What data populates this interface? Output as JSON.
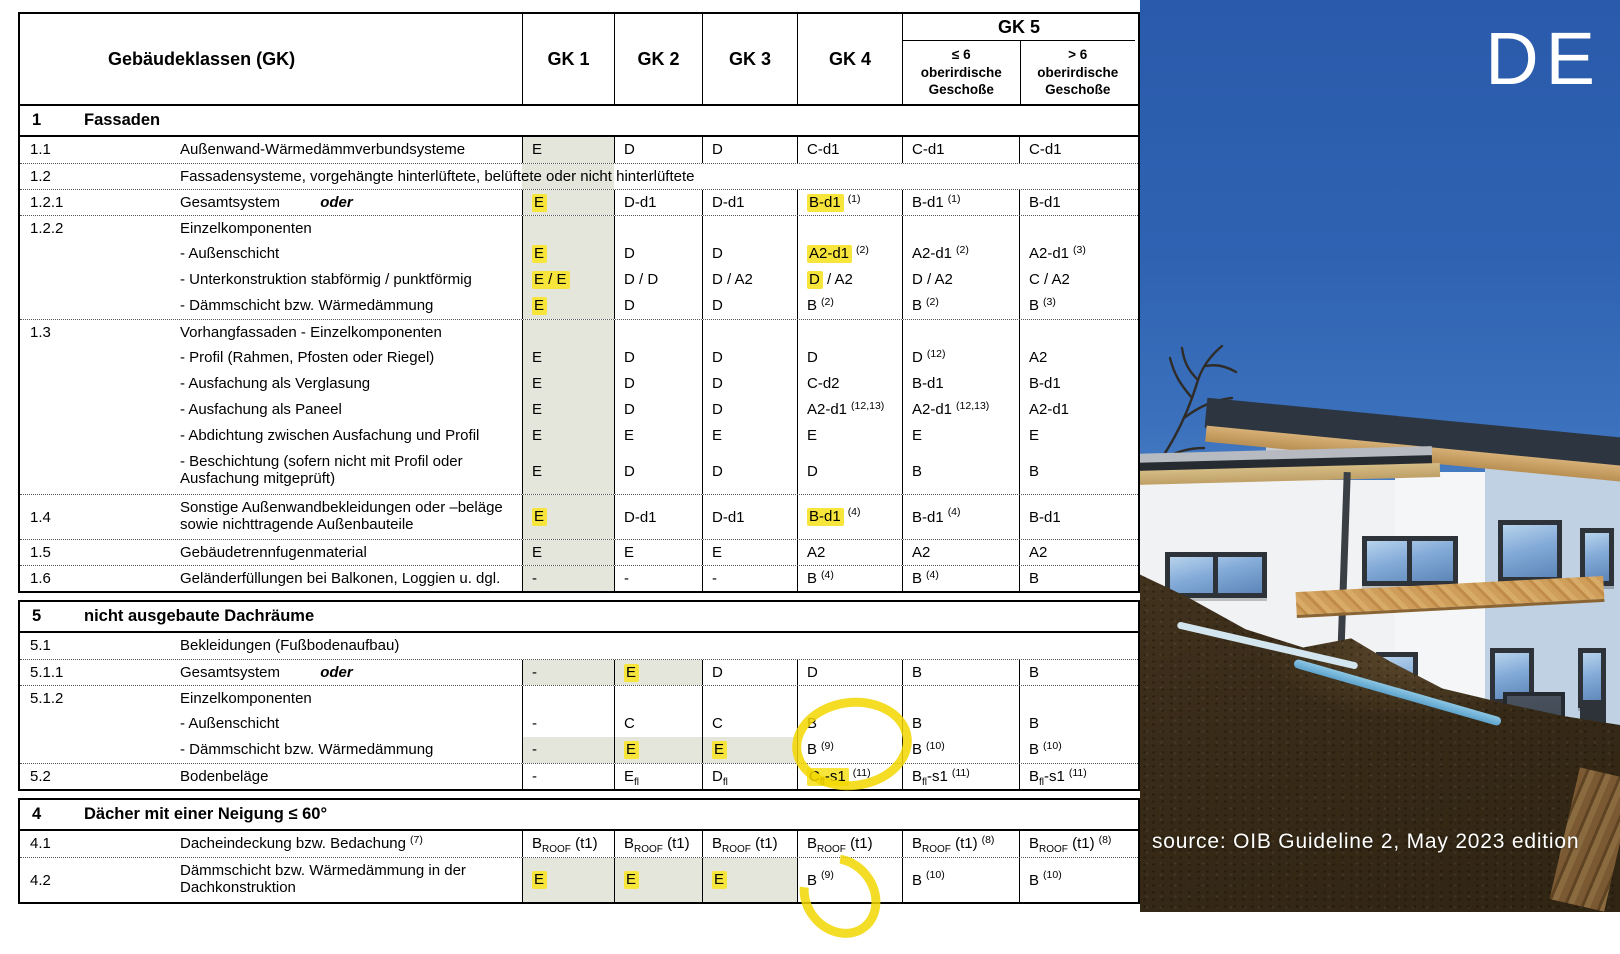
{
  "table": {
    "header": {
      "col0": "Gebäudeklassen (GK)",
      "gk_cols": [
        "GK 1",
        "GK 2",
        "GK 3",
        "GK 4"
      ],
      "gk5": {
        "label": "GK 5",
        "sub": [
          "≤ 6\noberirdische\nGeschoße",
          "> 6\noberirdische\nGeschoße"
        ]
      }
    },
    "sections": [
      {
        "num": "1",
        "title": "Fassaden",
        "rows": [
          {
            "type": "data",
            "num": "1.1",
            "label": "Außenwand-Wärmedämmverbundsysteme",
            "cells": [
              {
                "t": "E",
                "g": 1
              },
              {
                "t": "D"
              },
              {
                "t": "D"
              },
              {
                "t": "C-d1"
              },
              {
                "t": "C-d1"
              },
              {
                "t": "C-d1"
              }
            ]
          },
          {
            "type": "span",
            "num": "1.2",
            "g": 1,
            "label": "Fassadensysteme, vorgehängte hinterlüftete, belüftete oder nicht hinterlüftete"
          },
          {
            "type": "data",
            "num": "1.2.1",
            "label": "Gesamtsystem",
            "italic": "oder",
            "cells": [
              {
                "t": "[[E]]",
                "g": 1
              },
              {
                "t": "D-d1"
              },
              {
                "t": "D-d1"
              },
              {
                "t": "[[B-d1]]",
                "sup": "(1)"
              },
              {
                "t": "B-d1",
                "sup": "(1)"
              },
              {
                "t": "B-d1"
              }
            ]
          },
          {
            "type": "group",
            "num": "1.2.2",
            "label": "Einzelkomponenten",
            "cells": [
              {
                "g": 1
              },
              {},
              {},
              {},
              {},
              {}
            ]
          },
          {
            "type": "data",
            "num": "",
            "label": "- Außenschicht",
            "cells": [
              {
                "t": "[[E]]",
                "g": 1
              },
              {
                "t": "D"
              },
              {
                "t": "D"
              },
              {
                "t": "[[A2-d1]]",
                "sup": "(2)"
              },
              {
                "t": "A2-d1",
                "sup": "(2)"
              },
              {
                "t": "A2-d1",
                "sup": "(3)"
              }
            ]
          },
          {
            "type": "data",
            "num": "",
            "label": "- Unterkonstruktion stabförmig / punktförmig",
            "cells": [
              {
                "t": "[[E / E]]",
                "g": 1
              },
              {
                "t": "D / D"
              },
              {
                "t": "D / A2"
              },
              {
                "t": "[[D]] / A2"
              },
              {
                "t": "D / A2"
              },
              {
                "t": "C / A2"
              }
            ]
          },
          {
            "type": "data",
            "num": "",
            "label": "- Dämmschicht bzw. Wärmedämmung",
            "cells": [
              {
                "t": "[[E]]",
                "g": 1
              },
              {
                "t": "D"
              },
              {
                "t": "D"
              },
              {
                "t": "B",
                "sup": "(2)"
              },
              {
                "t": "B",
                "sup": "(2)"
              },
              {
                "t": "B",
                "sup": "(3)"
              }
            ]
          },
          {
            "type": "group",
            "num": "1.3",
            "label": "Vorhangfassaden - Einzelkomponenten",
            "cells": [
              {
                "g": 1
              },
              {},
              {},
              {},
              {},
              {}
            ]
          },
          {
            "type": "data",
            "num": "",
            "label": "- Profil (Rahmen, Pfosten oder Riegel)",
            "cells": [
              {
                "t": "E",
                "g": 1
              },
              {
                "t": "D"
              },
              {
                "t": "D"
              },
              {
                "t": "D"
              },
              {
                "t": "D",
                "sup": "(12)"
              },
              {
                "t": "A2"
              }
            ]
          },
          {
            "type": "data",
            "num": "",
            "label": "- Ausfachung als Verglasung",
            "cells": [
              {
                "t": "E",
                "g": 1
              },
              {
                "t": "D"
              },
              {
                "t": "D"
              },
              {
                "t": "C-d2"
              },
              {
                "t": "B-d1"
              },
              {
                "t": "B-d1"
              }
            ]
          },
          {
            "type": "data",
            "num": "",
            "label": "- Ausfachung als Paneel",
            "cells": [
              {
                "t": "E",
                "g": 1
              },
              {
                "t": "D"
              },
              {
                "t": "D"
              },
              {
                "t": "A2-d1",
                "sup": "(12,13)"
              },
              {
                "t": "A2-d1",
                "sup": "(12,13)"
              },
              {
                "t": "A2-d1"
              }
            ]
          },
          {
            "type": "data",
            "num": "",
            "label": "- Abdichtung zwischen Ausfachung und Profil",
            "cells": [
              {
                "t": "E",
                "g": 1
              },
              {
                "t": "E"
              },
              {
                "t": "E"
              },
              {
                "t": "E"
              },
              {
                "t": "E"
              },
              {
                "t": "E"
              }
            ]
          },
          {
            "type": "data",
            "num": "",
            "label": "- Beschichtung (sofern nicht mit Profil oder",
            "label2": "Ausfachung mitgeprüft)",
            "cells": [
              {
                "t": "E",
                "g": 1
              },
              {
                "t": "D"
              },
              {
                "t": "D"
              },
              {
                "t": "D"
              },
              {
                "t": "B"
              },
              {
                "t": "B"
              }
            ]
          },
          {
            "type": "data",
            "num": "1.4",
            "label": "Sonstige Außenwandbekleidungen oder –beläge",
            "label2": "sowie nichttragende Außenbauteile",
            "cells": [
              {
                "t": "[[E]]",
                "g": 1
              },
              {
                "t": "D-d1"
              },
              {
                "t": "D-d1"
              },
              {
                "t": "[[B-d1]]",
                "sup": "(4)"
              },
              {
                "t": "B-d1",
                "sup": "(4)"
              },
              {
                "t": "B-d1"
              }
            ]
          },
          {
            "type": "data",
            "num": "1.5",
            "label": "Gebäudetrennfugenmaterial",
            "cells": [
              {
                "t": "E",
                "g": 1
              },
              {
                "t": "E"
              },
              {
                "t": "E"
              },
              {
                "t": "A2"
              },
              {
                "t": "A2"
              },
              {
                "t": "A2"
              }
            ]
          },
          {
            "type": "data",
            "num": "1.6",
            "label": "Geländerfüllungen bei Balkonen, Loggien u. dgl.",
            "cells": [
              {
                "t": "-",
                "g": 1
              },
              {
                "t": "-"
              },
              {
                "t": "-"
              },
              {
                "t": "B",
                "sup": "(4)"
              },
              {
                "t": "B",
                "sup": "(4)"
              },
              {
                "t": "B"
              }
            ]
          }
        ]
      },
      {
        "num": "5",
        "title": "nicht ausgebaute Dachräume",
        "rows": [
          {
            "type": "span",
            "num": "5.1",
            "label": "Bekleidungen (Fußbodenaufbau)"
          },
          {
            "type": "data",
            "num": "5.1.1",
            "label": "Gesamtsystem",
            "italic": "oder",
            "cells": [
              {
                "t": "-",
                "g": 1
              },
              {
                "t": "[[E]]",
                "g": 1
              },
              {
                "t": "D"
              },
              {
                "t": "D"
              },
              {
                "t": "B"
              },
              {
                "t": "B"
              }
            ]
          },
          {
            "type": "group",
            "num": "5.1.2",
            "label": "Einzelkomponenten",
            "cells": [
              {},
              {},
              {},
              {},
              {},
              {}
            ]
          },
          {
            "type": "data",
            "num": "",
            "label": "- Außenschicht",
            "cells": [
              {
                "t": "-"
              },
              {
                "t": "C"
              },
              {
                "t": "C"
              },
              {
                "t": "B"
              },
              {
                "t": "B"
              },
              {
                "t": "B"
              }
            ]
          },
          {
            "type": "data",
            "num": "",
            "label": "- Dämmschicht bzw. Wärmedämmung",
            "cells": [
              {
                "t": "-",
                "g": 1
              },
              {
                "t": "[[E]]",
                "g": 1
              },
              {
                "t": "[[E]]",
                "g": 1
              },
              {
                "t": "B",
                "sup": "(9)"
              },
              {
                "t": "B",
                "sup": "(10)"
              },
              {
                "t": "B",
                "sup": "(10)"
              }
            ]
          },
          {
            "type": "data",
            "num": "5.2",
            "label": "Bodenbeläge",
            "cells": [
              {
                "t": "-"
              },
              {
                "t": "E{fl}"
              },
              {
                "t": "D{fl}"
              },
              {
                "t": "[[C{fl}-s1]]",
                "sup": "(11)"
              },
              {
                "t": "B{fl}-s1",
                "sup": "(11)"
              },
              {
                "t": "B{fl}-s1",
                "sup": "(11)"
              }
            ]
          }
        ]
      },
      {
        "num": "4",
        "title": "Dächer mit einer Neigung ≤ 60°",
        "rows": [
          {
            "type": "data",
            "num": "4.1",
            "label": "Dacheindeckung bzw. Bedachung",
            "label_sup": "(7)",
            "cells": [
              {
                "t": "B{ROOF} (t1)"
              },
              {
                "t": "B{ROOF} (t1)"
              },
              {
                "t": "B{ROOF} (t1)"
              },
              {
                "t": "B{ROOF} (t1)"
              },
              {
                "t": "B{ROOF} (t1)",
                "sup": "(8)"
              },
              {
                "t": "B{ROOF} (t1)",
                "sup": "(8)"
              }
            ]
          },
          {
            "type": "data",
            "num": "4.2",
            "label": "Dämmschicht bzw. Wärmedämmung in der",
            "label2": "Dachkonstruktion",
            "cells": [
              {
                "t": "[[E]]",
                "g": 1
              },
              {
                "t": "[[E]]",
                "g": 1
              },
              {
                "t": "[[E]]",
                "g": 1
              },
              {
                "t": "B",
                "sup": "(9)"
              },
              {
                "t": "B",
                "sup": "(10)"
              },
              {
                "t": "B",
                "sup": "(10)"
              }
            ]
          }
        ]
      }
    ],
    "markers": [
      {
        "desc": "hand-drawn yellow circle around GK 4 values of rows 5.1.2 Außenschicht and Dämmschicht (B / B (9))"
      },
      {
        "desc": "hand-drawn yellow circle around GK 4 value of row 4.2 (B (9))"
      }
    ]
  },
  "photo": {
    "tag": "DE",
    "caption": "source: OIB Guideline 2, May 2023 edition"
  },
  "colors": {
    "highlight": "#f7e53c",
    "shade": "#e4e5db",
    "marker": "#f3d700",
    "sky": "#2f63b2",
    "xps_insulation": "#a9d6e8"
  }
}
